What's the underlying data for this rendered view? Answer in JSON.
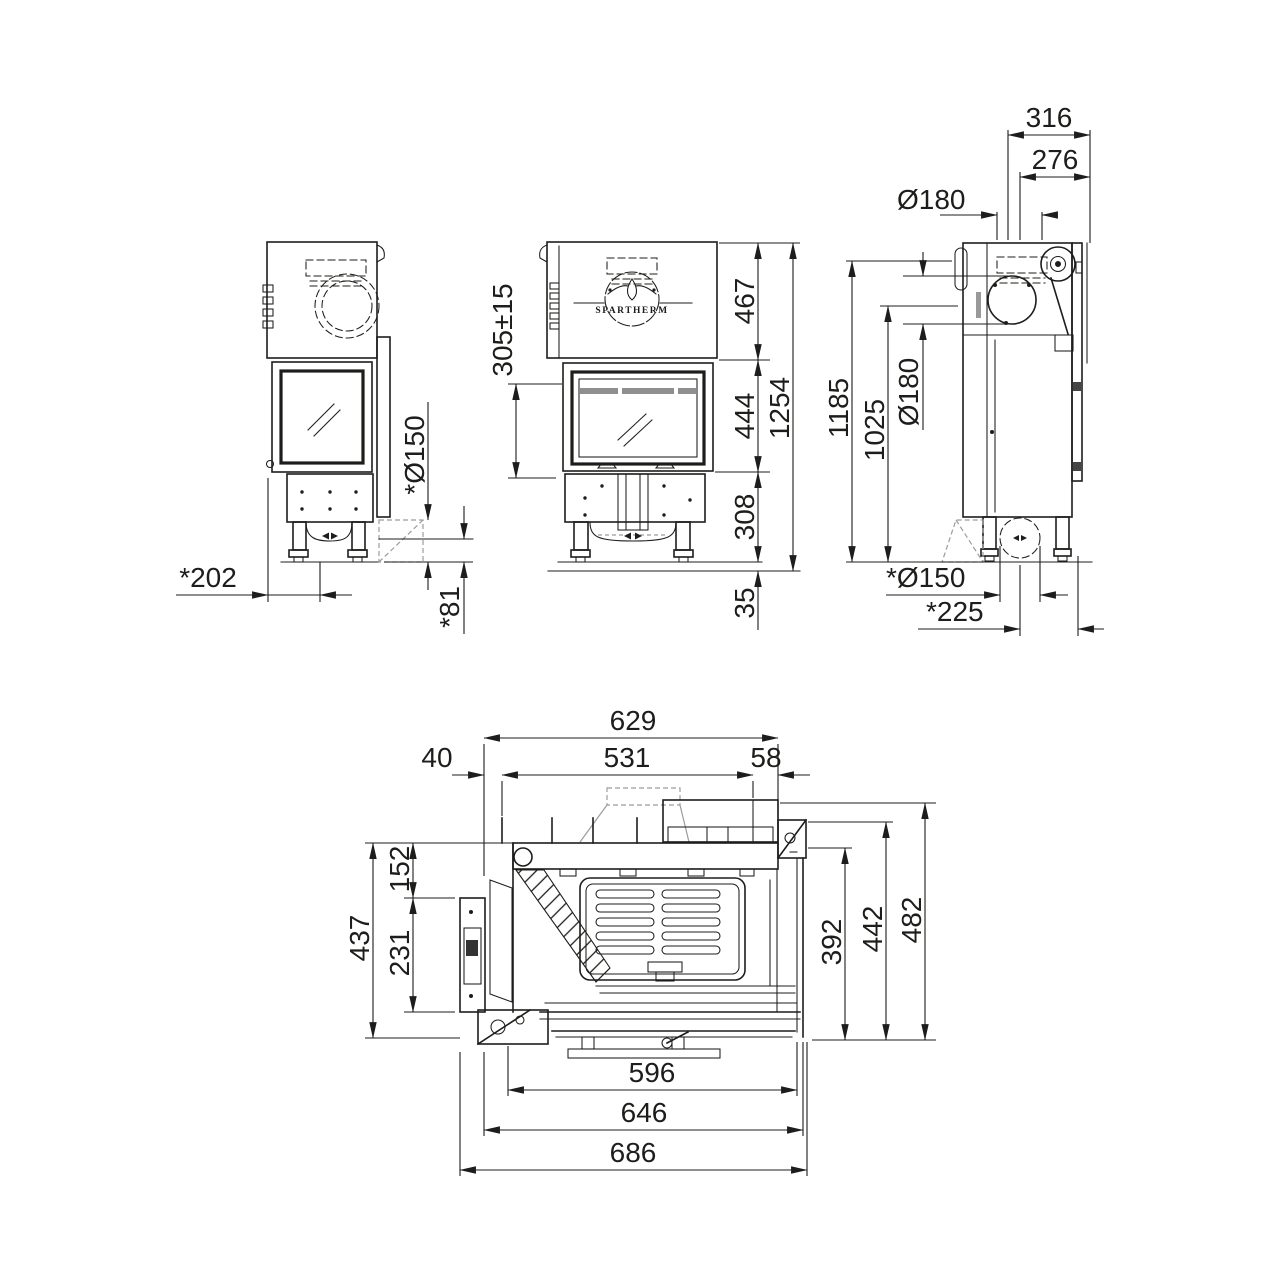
{
  "drawing": {
    "brand": "SPARTHERM",
    "views": {
      "side_left": {
        "dims": {
          "rear_offset": "*202",
          "plinth_height": "*81",
          "flue_rear": "*Ø150"
        }
      },
      "front": {
        "logo": "SPARTHERM",
        "dims": {
          "hood_range": "305±15",
          "hood_height": "467",
          "door_height": "444",
          "base_height": "308",
          "floor_gap": "35",
          "total_height": "1254"
        }
      },
      "side_right": {
        "dims": {
          "depth_top": "316",
          "flue_center_offset": "276",
          "flue_dia_top": "Ø180",
          "height_total": "1185",
          "height_flue_axis": "1025",
          "flue_dia_side": "Ø180",
          "flue_rear_dia": "*Ø150",
          "flue_rear_center": "*225"
        }
      },
      "plan": {
        "dims": {
          "depth_body": "629",
          "front_edge": "40",
          "depth_inner": "531",
          "rear_edge": "58",
          "depth_left": "437",
          "depth_front_seg": "152",
          "depth_door_seg": "231",
          "width_inner": "392",
          "width_mid": "442",
          "width_outer": "482",
          "width_glass": "596",
          "width_body": "646",
          "width_total": "686"
        }
      }
    }
  }
}
